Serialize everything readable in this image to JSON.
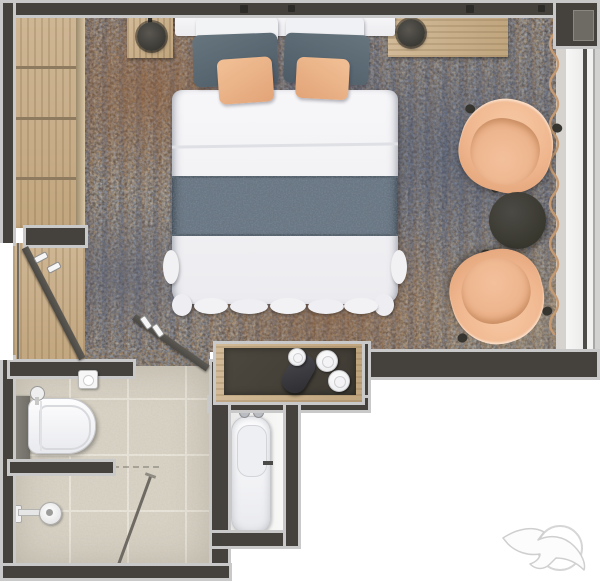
{
  "meta": {
    "type": "floor-plan-rendering",
    "view": "top-down",
    "subject": "hotel guest room with ensuite bathroom"
  },
  "palette": {
    "exterior": "#ffffff",
    "wall": "#45423e",
    "wallPanel": "#6e6a64",
    "trim": "#c9c9c9",
    "doorLeaf": "#55524d",
    "rugBase": "#6a6058",
    "rugBlue": "#57627a",
    "rugOrange": "#96582c",
    "rugBeige": "#b3a48c",
    "wood": "#c9b08c",
    "woodEdge": "#9c8a6d",
    "bedWhite": "#f4f4f6",
    "runner": "#697683",
    "pillowSlate": "#5a6873",
    "peach": "#f0b78f",
    "peachDeep": "#df9f74",
    "peachLight": "#f6c9a5",
    "lampDark": "#474540",
    "counterTop": "#46423a",
    "tableDark": "#3d3c38",
    "tile": "#d8d2c5",
    "grout": "#e9e4d9",
    "fixtureGray": "#7d7a74",
    "curtain": "#c59a72",
    "glazing": "#4e4c49",
    "watermark": "#cfcfcf"
  },
  "furniture": {
    "wardrobe": "Wardrobe with open shelves",
    "nightstand_left": "Left nightstand with lamp",
    "console": "Console shelf with lamp",
    "bed": "Double bed with bed runner and pillows",
    "rug": "Patterned area rug",
    "armchair_top": "Lounge armchair",
    "armchair_bottom": "Lounge armchair",
    "side_table": "Round side table",
    "curtain": "Window curtain",
    "window": "Window wall",
    "minibar_counter": "Minibar counter with kettle and cups",
    "kettle": "Electric kettle",
    "cups": "Cups with saucers",
    "entry_door": "Entry door (open)",
    "bathroom_door": "Bathroom sliding door",
    "toilet": "Toilet",
    "toilet_paper": "Toilet paper holder",
    "shower": "Shower head",
    "shower_partition": "Shower partition",
    "vanity_sink": "Vanity sink basin",
    "entry_floor": "Entry wood floor",
    "bathroom_floor": "Tiled bathroom floor",
    "watermark": "Seagull logo watermark"
  }
}
